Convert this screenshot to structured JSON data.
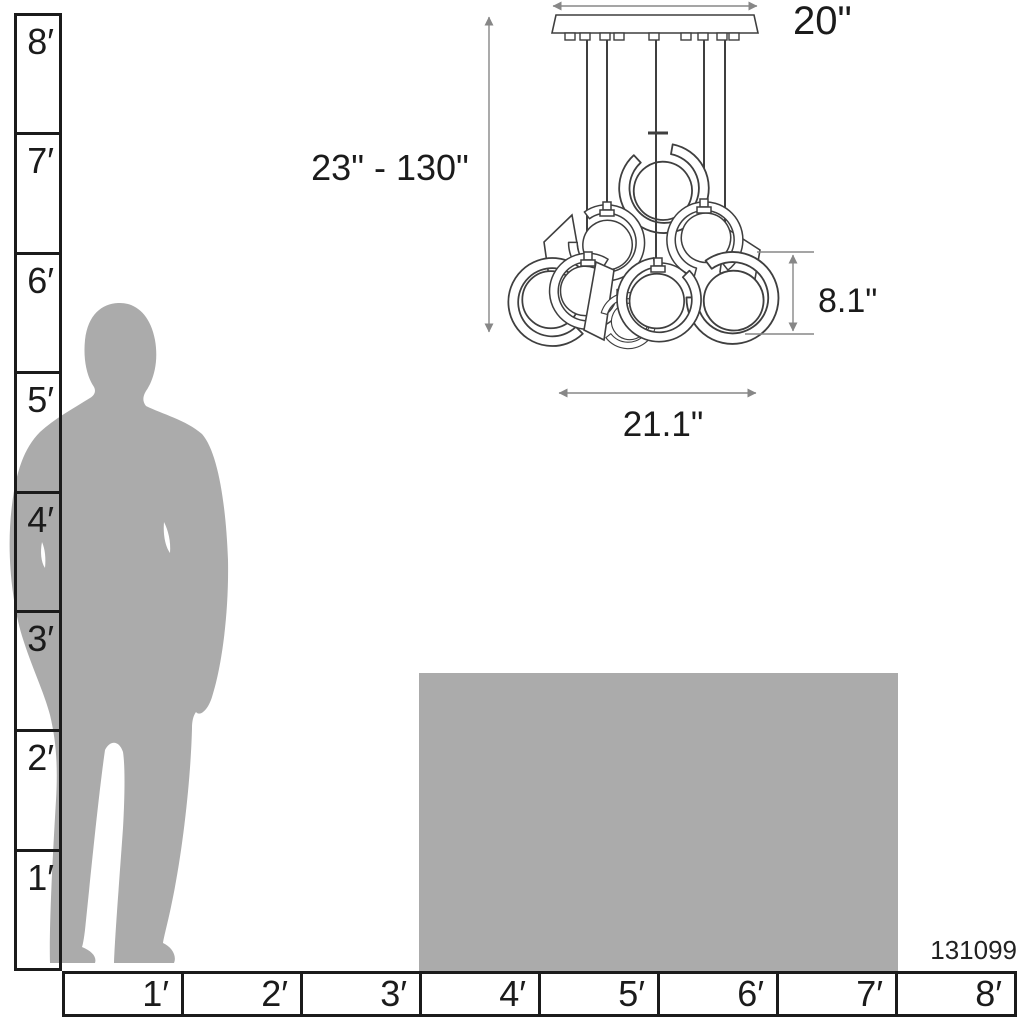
{
  "diagram": {
    "sku": "131099",
    "dimension_labels": {
      "canopy_width": "20\"",
      "suspension_height_range": "23\" - 130\"",
      "shade_height": "8.1\"",
      "fixture_width": "21.1\""
    },
    "vertical_ruler": {
      "labels": [
        "8′",
        "7′",
        "6′",
        "5′",
        "4′",
        "3′",
        "2′",
        "1′"
      ]
    },
    "horizontal_ruler": {
      "labels": [
        "1′",
        "2′",
        "3′",
        "4′",
        "5′",
        "6′",
        "7′",
        "8′"
      ]
    },
    "colors": {
      "background": "#ffffff",
      "silhouette_gray": "#ababab",
      "table_gray": "#ababab",
      "fixture_outline": "#3f3f3f",
      "dimension_line_gray": "#878787",
      "ruler_black": "#1b1b1b",
      "text_black": "#1b1b1b"
    }
  }
}
